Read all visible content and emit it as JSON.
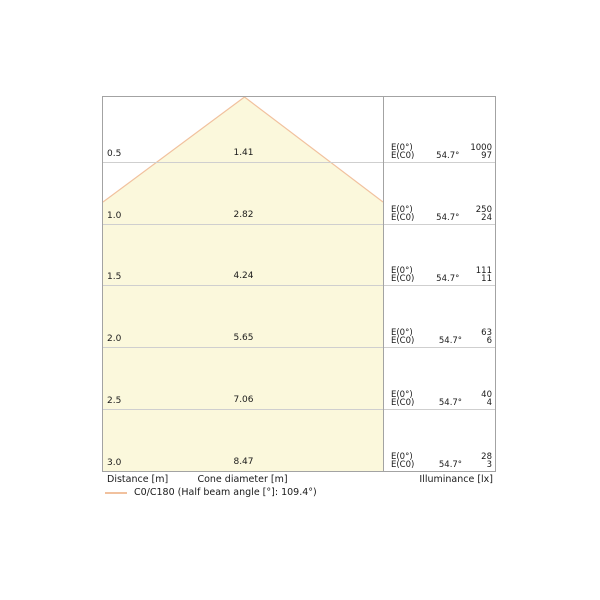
{
  "diagram": {
    "rows": [
      {
        "distance": "0.5",
        "diameter": "1.41",
        "e0_label": "E(0°)",
        "ec0_label": "E(C0)",
        "angle": "54.7°",
        "e0": "1000",
        "ec0": "97"
      },
      {
        "distance": "1.0",
        "diameter": "2.82",
        "e0_label": "E(0°)",
        "ec0_label": "E(C0)",
        "angle": "54.7°",
        "e0": "250",
        "ec0": "24"
      },
      {
        "distance": "1.5",
        "diameter": "4.24",
        "e0_label": "E(0°)",
        "ec0_label": "E(C0)",
        "angle": "54.7°",
        "e0": "111",
        "ec0": "11"
      },
      {
        "distance": "2.0",
        "diameter": "5.65",
        "e0_label": "E(0°)",
        "ec0_label": "E(C0)",
        "angle": "54.7°",
        "e0": "63",
        "ec0": "6"
      },
      {
        "distance": "2.5",
        "diameter": "7.06",
        "e0_label": "E(0°)",
        "ec0_label": "E(C0)",
        "angle": "54.7°",
        "e0": "40",
        "ec0": "4"
      },
      {
        "distance": "3.0",
        "diameter": "8.47",
        "e0_label": "E(0°)",
        "ec0_label": "E(C0)",
        "angle": "54.7°",
        "e0": "28",
        "ec0": "3"
      }
    ],
    "footer": {
      "distance": "Distance [m]",
      "cone_diameter": "Cone diameter [m]",
      "illuminance": "Illuminance [lx]"
    },
    "legend_label": "C0/C180 (Half beam angle [°]: 109.4°)"
  },
  "colors": {
    "cone_fill": "#FBF8DC",
    "cone_stroke": "#F1C19E",
    "gridline": "#CFCFCF",
    "border": "#A3A3A3",
    "text": "#1A1A1A"
  },
  "chart_data": {
    "type": "table",
    "title": "Light cone diagram",
    "columns": [
      "Distance [m]",
      "Cone diameter [m]",
      "E(0°) [lx]",
      "E(C0) [lx]",
      "Beam half angle [°]"
    ],
    "distance_m": [
      0.5,
      1.0,
      1.5,
      2.0,
      2.5,
      3.0
    ],
    "cone_diameter_m": [
      1.41,
      2.82,
      4.24,
      5.65,
      7.06,
      8.47
    ],
    "illuminance_E0_lx": [
      1000,
      250,
      111,
      63,
      40,
      28
    ],
    "illuminance_EC0_lx": [
      97,
      24,
      11,
      6,
      4,
      3
    ],
    "angle_per_row_deg": 54.7,
    "half_beam_angle_deg": 109.4,
    "legend": "C0/C180 (Half beam angle [°]: 109.4°)",
    "legend_position": "bottom-left",
    "grid": true
  }
}
